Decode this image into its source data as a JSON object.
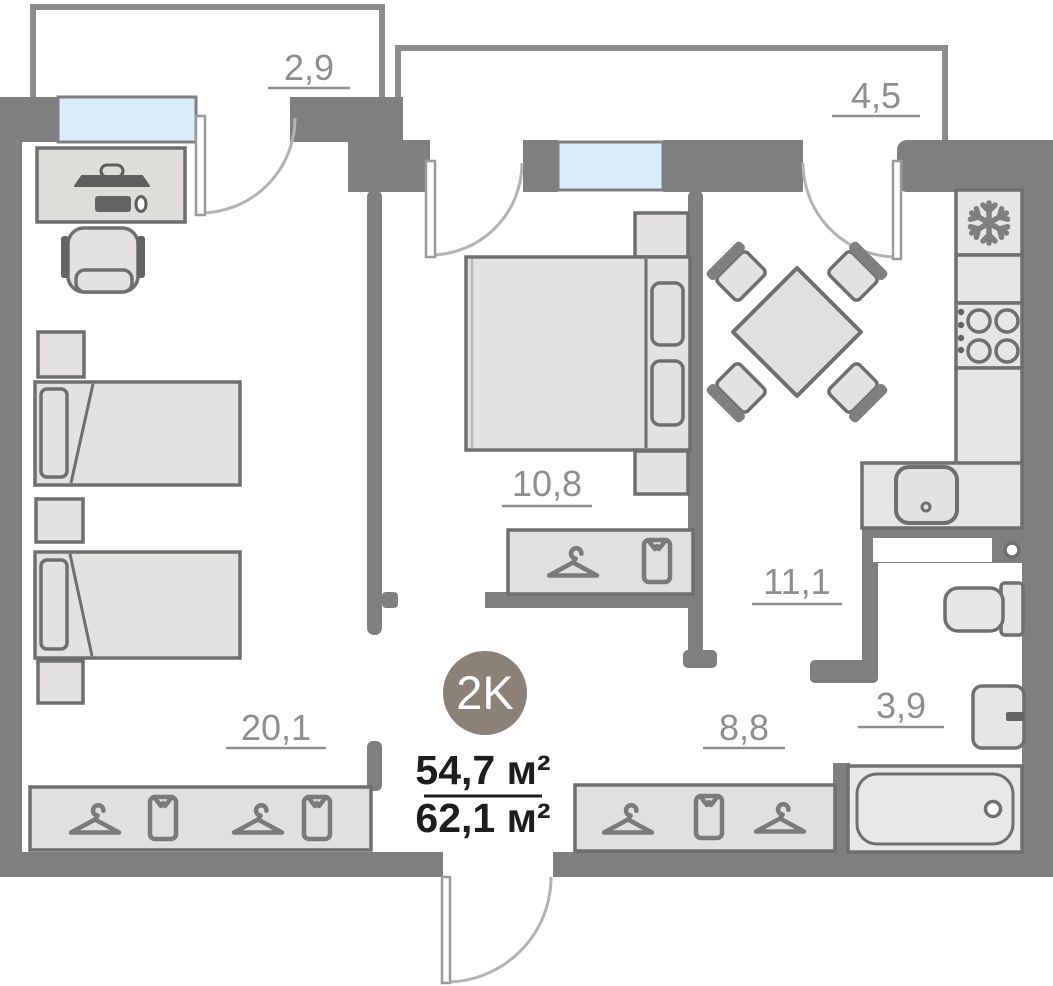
{
  "plan": {
    "badge": {
      "label": "2K"
    },
    "areas": {
      "living": "54,7 м²",
      "total": "62,1 м²"
    },
    "rooms": {
      "balcony_small": {
        "name": "balcony-small",
        "area": "2,9"
      },
      "balcony_large": {
        "name": "balcony-large",
        "area": "4,5"
      },
      "bedroom": {
        "name": "bedroom",
        "area": "10,8"
      },
      "kitchen": {
        "name": "kitchen",
        "area": "11,1"
      },
      "living_room": {
        "name": "living-room",
        "area": "20,1"
      },
      "hallway": {
        "name": "hallway",
        "area": "8,8"
      },
      "bathroom": {
        "name": "bathroom",
        "area": "3,9"
      }
    },
    "colors": {
      "wall": "#7f7f7f",
      "balcony_wall": "#8d8d8d",
      "furniture_fill": "#e3e2e0",
      "furniture_stroke": "#6f6f6f",
      "window": "#d9ecf9",
      "label": "#8e8e8e",
      "badge": "#8b8177",
      "area_text": "#1d1d1d"
    }
  }
}
